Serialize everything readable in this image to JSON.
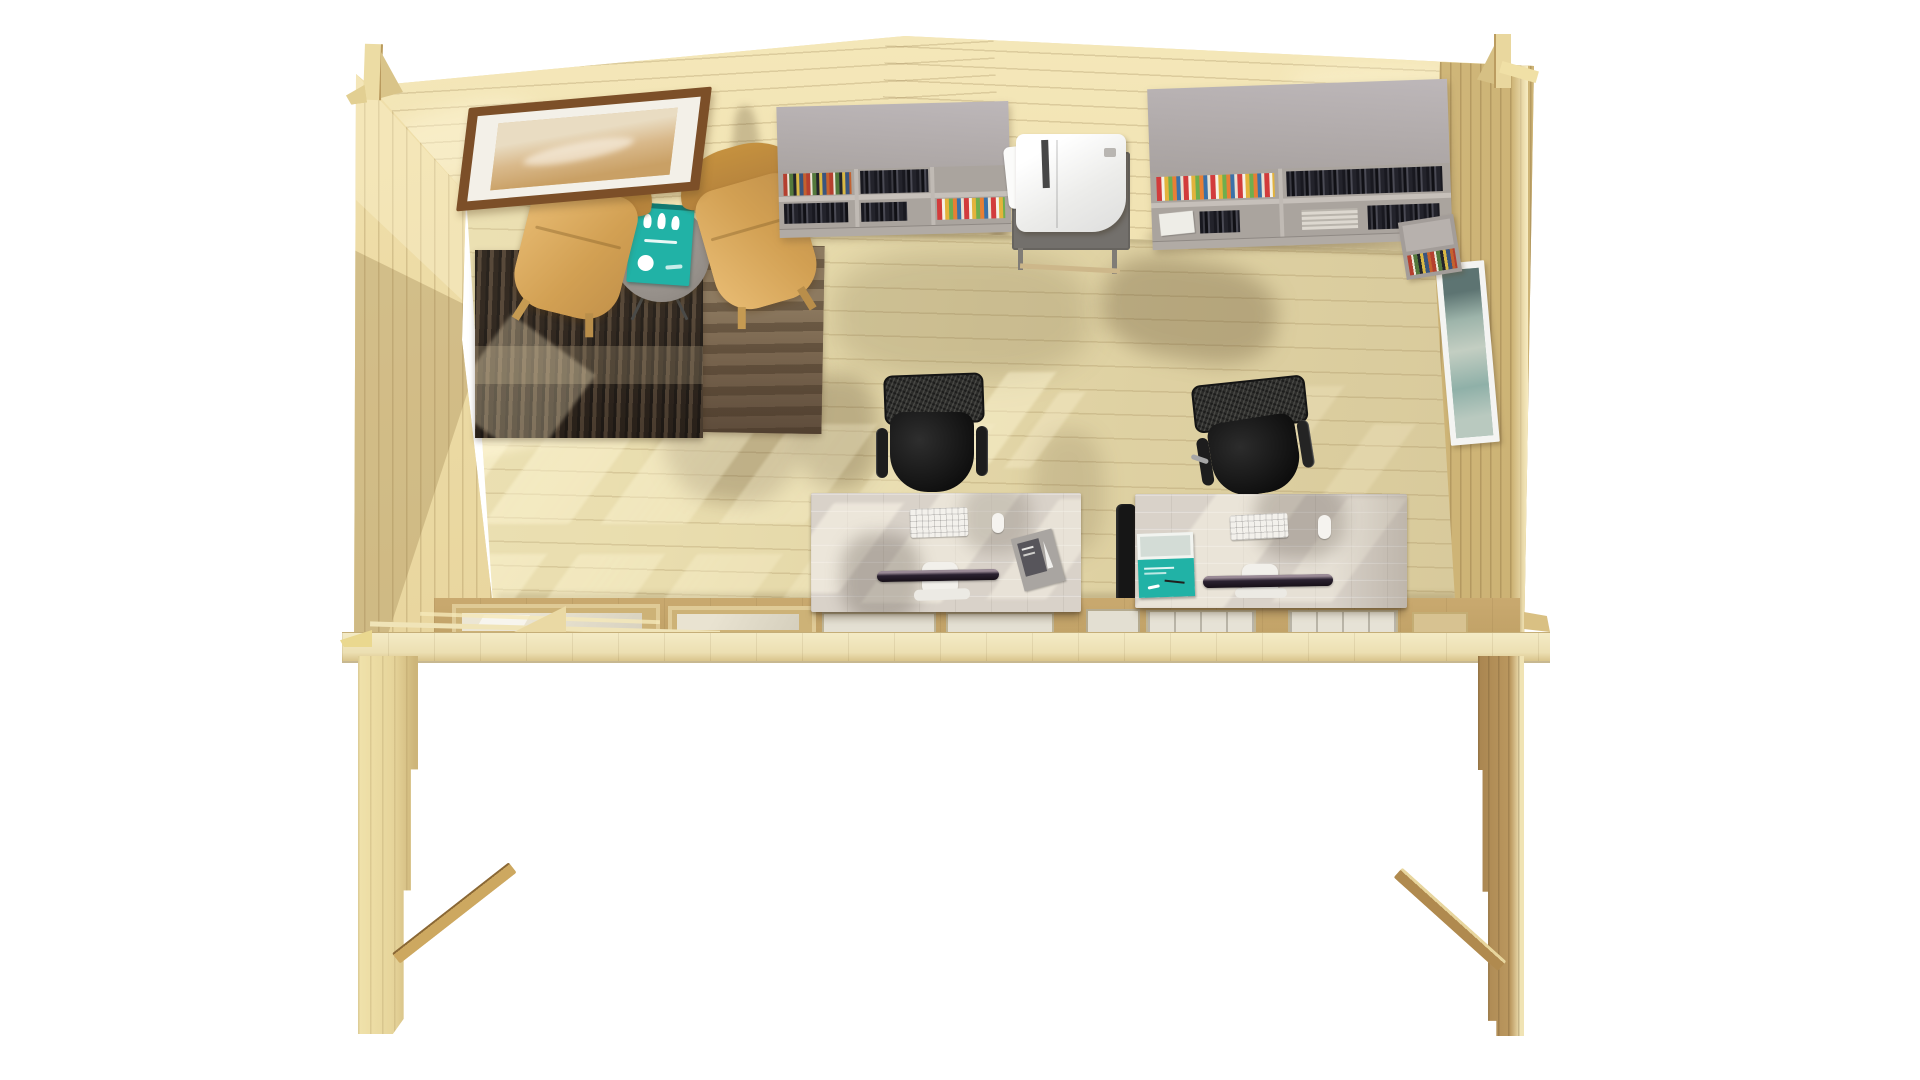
{
  "meta": {
    "kind": "3d-interior-render",
    "background": "#ffffff"
  },
  "palette": {
    "wood_floor": "#e9ddae",
    "wood_backwall": "#eedfab",
    "wood_leftwall": "#ecd9a4",
    "wood_rightwall": "#d8c083",
    "wood_band": "#c8a76c",
    "wood_beam": "#f2e9c4",
    "leg_light": "#ecdca0",
    "leg_dark": "#b5915a",
    "brace_tan": "#c9a159",
    "shelf_gray": "#b4aeb0",
    "shelf_front": "#aaa49e",
    "stand_gray": "#73706c",
    "printer_white": "#f7f6f4",
    "rug_dark": "#3f352c",
    "rug_brown": "#7b6750",
    "armchair_tan": "#d7a75e",
    "table_gray": "#9a948e",
    "accent_teal": "#21b2a6",
    "desk_white": "#d9d2c9",
    "chair_black": "#161616",
    "monitor_dark": "#2a2130",
    "frame_brown": "#7c4f28",
    "picture_mat": "#f3f0e8",
    "art_sand": "#d9b98b",
    "art_teal": "#8fb0a8"
  },
  "scene": {
    "objects": [
      "gabled-cabin-shell",
      "back-wall",
      "left-wall",
      "right-wall",
      "plank-floor",
      "front-window-beam",
      "support-leg-left",
      "support-leg-right",
      "diagonal-brace-left",
      "diagonal-brace-right",
      "framed-picture-back-wall",
      "framed-picture-right-wall",
      "armchair-left",
      "armchair-right",
      "round-side-table",
      "teal-game-box",
      "rug-dark",
      "rug-brown",
      "wall-shelf-left",
      "wall-shelf-right",
      "corner-shelf-block",
      "printer",
      "printer-stand",
      "office-desk-left",
      "office-desk-right",
      "keyboard-left",
      "keyboard-right",
      "mouse-left",
      "mouse-right",
      "monitor-left",
      "monitor-right",
      "desk-poster",
      "teal-booklet",
      "office-chair-left",
      "office-chair-right",
      "radiator-panel",
      "sunlight-patches",
      "cast-shadows"
    ]
  }
}
